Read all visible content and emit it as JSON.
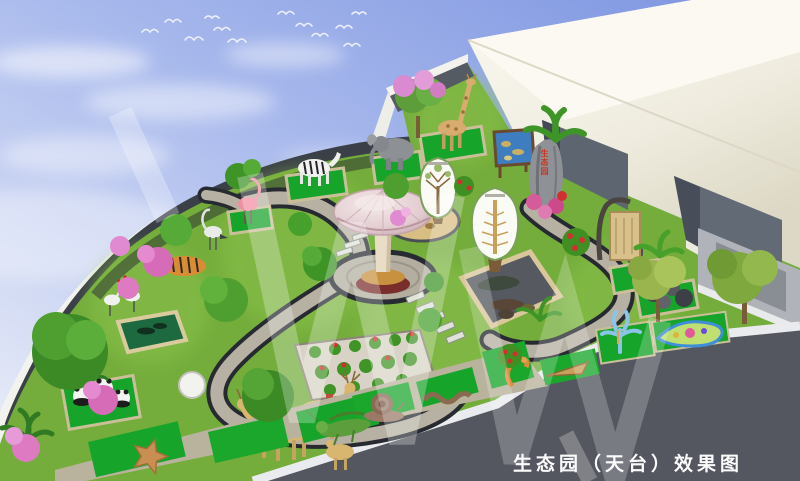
{
  "image": {
    "type": "3d architectural rendering",
    "subject": "rooftop ecological science garden concept",
    "title": "生态园（天台）效果图"
  },
  "caption": {
    "text": "生态园（天台）效果图",
    "color": "#fbfbfb"
  },
  "stone": {
    "text": "生态园",
    "color": "#cc3522"
  },
  "palette": {
    "sky_top": "#7b93e0",
    "sky_bottom": "#eef1f9",
    "lawn": "#74ad3b",
    "display_mat_green": "#17a42a",
    "cobble_path": "#b6b1a3",
    "path_edge": "#272b31",
    "parapet_dark": "#3b4048",
    "parapet_rim": "#f2f2ee",
    "building_cream": "#f1eee1",
    "building_opening": "#5d6571",
    "roof_deck_dark": "#54575f",
    "curb_white": "#e9ebee",
    "mushroom_cap": "#e7d3d6",
    "mushroom_base": "#7a2e2c",
    "sand": "#d9be83",
    "watermark": "rgba(255,255,255,0.27)"
  },
  "scene": {
    "sky": {
      "clouds": 5,
      "flying_birds": 12
    },
    "building": {
      "openings": 2,
      "material": "white concrete"
    },
    "garden_features": [
      "zebra-statue",
      "flamingo-statue",
      "heron-statue",
      "elephant-statue",
      "giraffe-statue",
      "tiger-statue",
      "crane-statues",
      "panda-statues",
      "deer-family-statues",
      "owl-statue",
      "stone-sphere-cluster",
      "reptile-display-pit",
      "sand-diorama",
      "mushroom-pavilion",
      "leaf-shaped-info-board-1",
      "leaf-shaped-info-board-2",
      "blue-map-signboard",
      "inscribed-stone",
      "hanging-wood-sign",
      "starfish-statue",
      "grasshopper-statue",
      "snail-statue",
      "worm-statue",
      "seahorse-statue",
      "coral-statue",
      "cell-model-display",
      "flower-bed-with-pots",
      "stepping-stones",
      "cobblestone-loop-path",
      "pink-blossom-tree",
      "azalea-shrubs",
      "white-dome-sculpture",
      "fish-pond-box"
    ]
  }
}
